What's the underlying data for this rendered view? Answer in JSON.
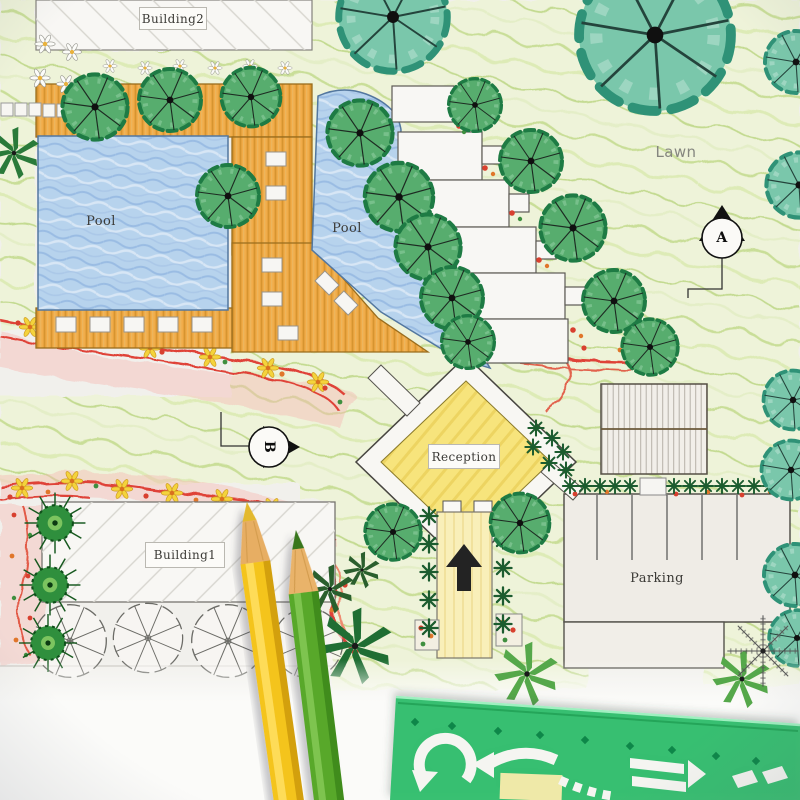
{
  "photo_subject": "hand-drawn landscape architecture site plan with colored pencils and green arrow stencil",
  "plan_labels": {
    "building2": "Building2",
    "pool_left": "Pool",
    "pool_center": "Pool",
    "lawn": "Lawn",
    "reception": "Reception",
    "building1": "Building1",
    "parking": "Parking"
  },
  "section_markers": {
    "a": "A",
    "b": "B"
  },
  "icons": {
    "entrance_arrow": "up-arrow-icon",
    "marker_a_shape": "triangle-up-icon",
    "marker_b_shape": "triangle-right-icon",
    "stencil_cutouts": "curved-and-block-arrow-icons"
  },
  "palette": {
    "paper": "#f1f0ec",
    "pool_blue": "#b7d3ed",
    "deck_orange": "#f1ac49",
    "lawn_green": "#eef3d9",
    "reception_yellow": "#f7e47c",
    "path_yellow": "#f9efb9",
    "flower_red": "#df4337",
    "tree_dark_green": "#57ad6e",
    "tree_teal": "#7ac7ab",
    "pencil_yellow": "#f4c41b",
    "pencil_green": "#59a82a",
    "stencil_green": "#2fbe6c"
  }
}
